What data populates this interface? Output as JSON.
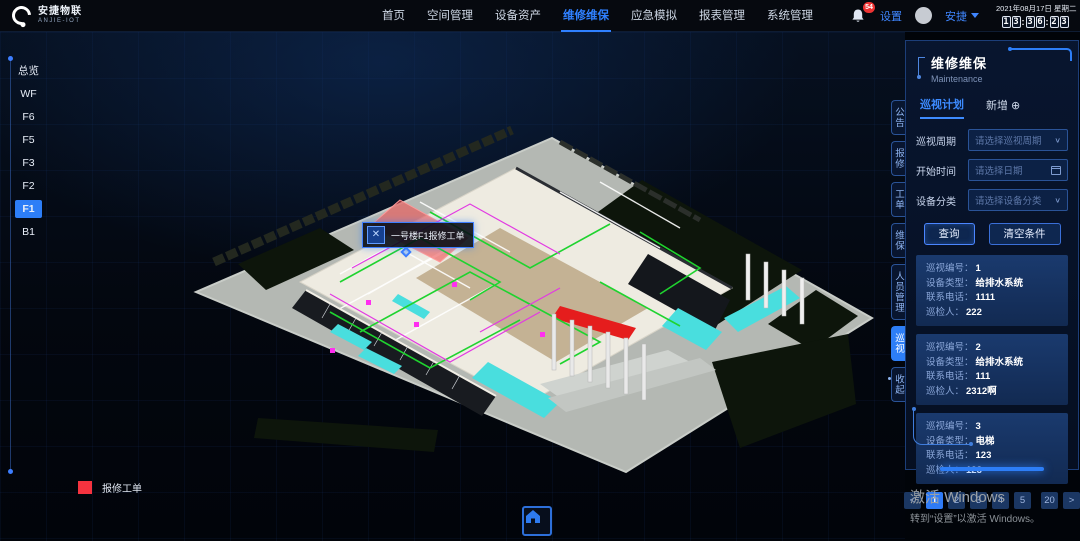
{
  "theme": {
    "accent": "#2d7ef7",
    "alert": "#f5333f"
  },
  "header": {
    "logo": {
      "title": "安捷物联",
      "subtitle": "ANJIE-IOT"
    },
    "menu": [
      {
        "label": "首页"
      },
      {
        "label": "空间管理"
      },
      {
        "label": "设备资产"
      },
      {
        "label": "维修维保"
      },
      {
        "label": "应急模拟"
      },
      {
        "label": "报表管理"
      },
      {
        "label": "系统管理"
      }
    ],
    "badge": "54",
    "settings_label": "设置",
    "user_name": "安捷",
    "clock": {
      "date": "2021年08月17日",
      "weekday": "星期二",
      "digits": [
        "1",
        "3",
        "3",
        "6",
        "2",
        "3"
      ],
      "colon": ":"
    }
  },
  "floors": {
    "items": [
      "总览",
      "WF",
      "F6",
      "F5",
      "F3",
      "F2",
      "F1",
      "B1"
    ],
    "active": "F1"
  },
  "side_tabs": {
    "items": [
      "公告",
      "报修",
      "工单",
      "维保",
      "人员管理",
      "巡视",
      "收起"
    ],
    "active": "巡视"
  },
  "panel": {
    "title": "维修维保",
    "subtitle": "Maintenance",
    "tabs": {
      "plan": "巡视计划",
      "add": "新增"
    },
    "icons": {
      "plus": "⊕",
      "chevron": "∨",
      "prev": "<",
      "next": ">"
    },
    "form": {
      "rows": [
        {
          "label": "巡视周期",
          "placeholder": "请选择巡视周期"
        },
        {
          "label": "开始时间",
          "placeholder": "请选择日期"
        },
        {
          "label": "设备分类",
          "placeholder": "请选择设备分类"
        }
      ],
      "query": "查询",
      "clear": "清空条件"
    },
    "cards": [
      {
        "rows": [
          {
            "label": "巡视编号：",
            "value": "1"
          },
          {
            "label": "设备类型：",
            "value": "给排水系统"
          },
          {
            "label": "联系电话：",
            "value": "1111"
          },
          {
            "label": "巡检人：",
            "value": "222"
          }
        ]
      },
      {
        "rows": [
          {
            "label": "巡视编号：",
            "value": "2"
          },
          {
            "label": "设备类型：",
            "value": "给排水系统"
          },
          {
            "label": "联系电话：",
            "value": "111"
          },
          {
            "label": "巡检人：",
            "value": "2312啊"
          }
        ]
      },
      {
        "rows": [
          {
            "label": "巡视编号：",
            "value": "3"
          },
          {
            "label": "设备类型：",
            "value": "电梯"
          },
          {
            "label": "联系电话：",
            "value": "123"
          },
          {
            "label": "巡检人：",
            "value": "123"
          }
        ]
      }
    ],
    "pagination": {
      "pages": [
        "1",
        "2",
        "3",
        "4",
        "5"
      ],
      "last": "20",
      "active": "1"
    }
  },
  "scene": {
    "tooltip": {
      "text": "一号楼F1报修工单"
    },
    "legend": {
      "label": "报修工单",
      "color": "#f5333f"
    }
  },
  "windows_activation": {
    "line1": "激活 Windows",
    "line2": "转到“设置”以激活 Windows。"
  }
}
